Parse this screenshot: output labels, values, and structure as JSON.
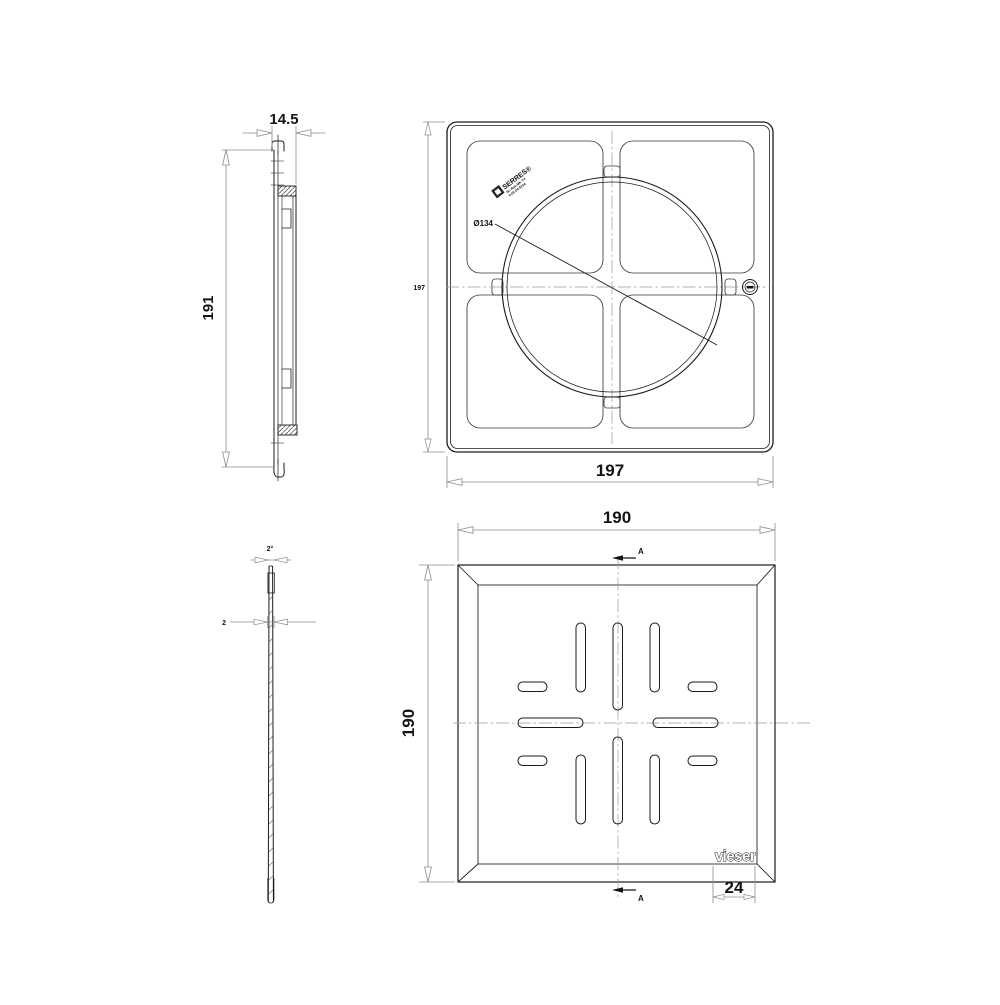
{
  "drawing": {
    "title": "floor-drain frame and grating technical drawing",
    "colors": {
      "object_line": "#1c1c1c",
      "dim_line": "#8c8c8c",
      "center_line": "#9a9a9a",
      "background": "#ffffff"
    },
    "views": {
      "frame_section": {
        "dim_width": "14.5",
        "dim_height": "191"
      },
      "frame_plan": {
        "dim_width_bottom": "197",
        "dim_height_left": "197",
        "dim_circle": "Ø134",
        "stamp": {
          "line1": "SERRES®",
          "line2": "Nr. Rak-MK TV",
          "line3": "6-05-04-5234"
        }
      },
      "grate_section": {
        "dim_draft_angle": "2°",
        "dim_thickness": "2"
      },
      "grate_plan": {
        "dim_width_top": "190",
        "dim_height_left": "190",
        "dim_logo_width": "24",
        "logo": "vieser",
        "section_label_top": "A",
        "section_label_bottom": "A"
      }
    }
  }
}
